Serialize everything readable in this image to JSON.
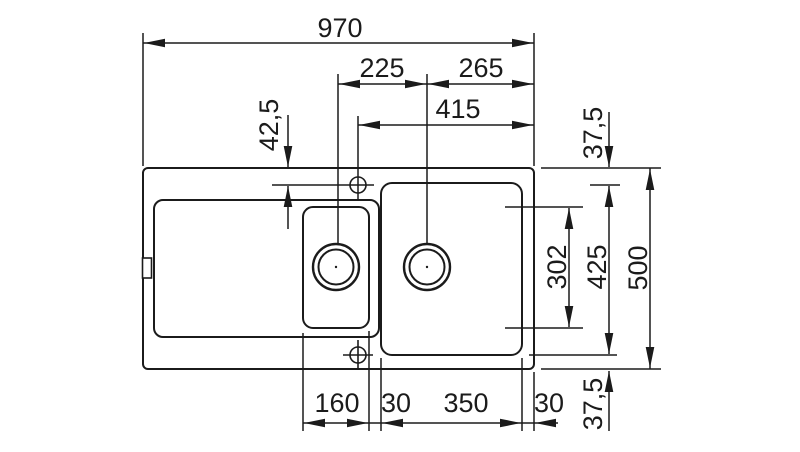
{
  "drawing": {
    "description": "Technical top-view dimension drawing of a kitchen sink with drainboard, one small bowl and one large bowl, two drain holes and two tap-hole center marks",
    "line_color": "#1b1b1b",
    "background_color": "#ffffff",
    "labels": {
      "overall_width": "970",
      "drain_center_spacing": "225",
      "drain_center_to_right_edge": "265",
      "tap_hole_to_right_edge": "415",
      "top_edge_to_tap_hole": "42,5",
      "top_edge_to_bowl": "37,5",
      "small_bowl_inner_length": "302",
      "large_bowl_length": "425",
      "overall_depth": "500",
      "small_bowl_width": "160",
      "bowl_gap": "30",
      "large_bowl_width": "350",
      "bowl_to_right_edge": "30",
      "bowl_to_bottom_edge": "37,5"
    }
  }
}
